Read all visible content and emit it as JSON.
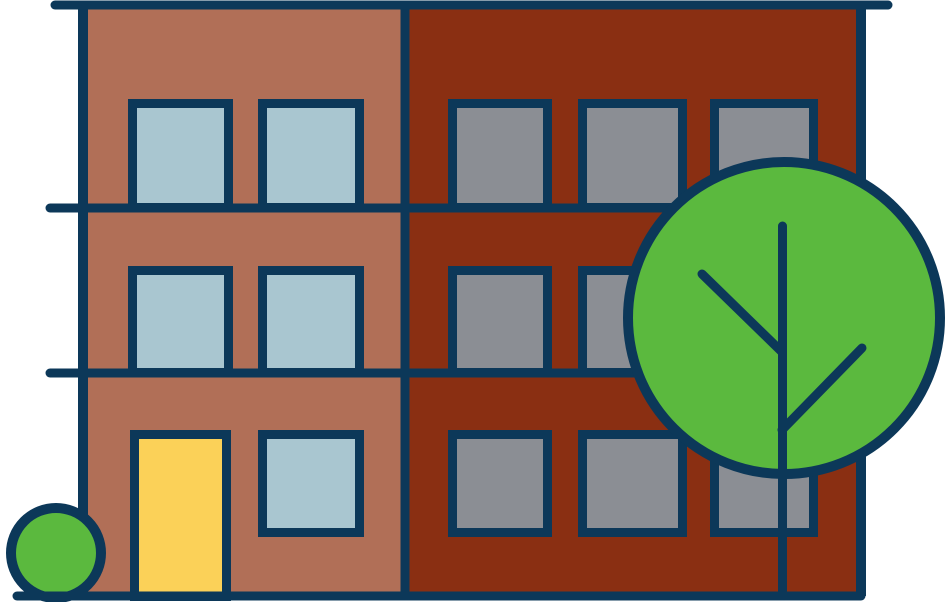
{
  "scene": {
    "description": "Flat cartoon illustration of a three-story apartment building with two sections, a large round tree and a small round bush",
    "background": "#ffffff"
  },
  "colors": {
    "bg": "#ffffff",
    "outline": "#0c3859",
    "leftWall": "#b16f57",
    "rightWall": "#8a2f12",
    "windowBlue": "#a9c6d0",
    "windowGray": "#8b8e94",
    "door": "#fbd158",
    "foliage": "#5bb93e"
  },
  "building": {
    "floors": 3,
    "left_section": {
      "window_count": 5,
      "door_count": 1,
      "window_color": "#a9c6d0",
      "wall_color": "#b16f57"
    },
    "right_section": {
      "window_count": 9,
      "window_color": "#8b8e94",
      "wall_color": "#8a2f12"
    }
  },
  "tree": {
    "branch_count": 2,
    "foliage_color": "#5bb93e"
  },
  "bush": {
    "count": 1,
    "color": "#5bb93e"
  }
}
